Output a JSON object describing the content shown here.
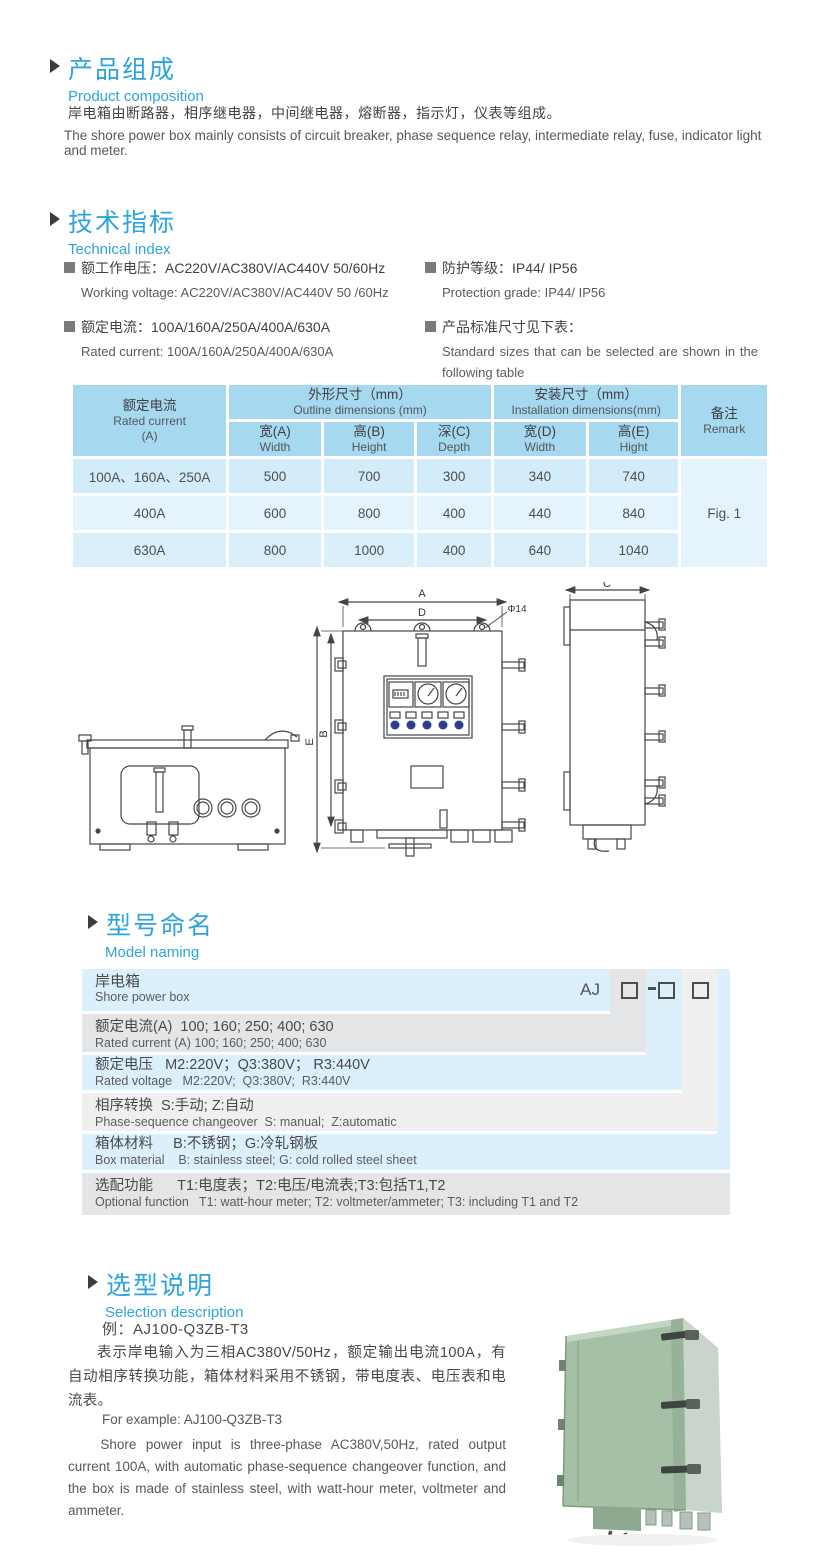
{
  "sections": {
    "composition": {
      "title_cn": "产品组成",
      "title_en": "Product  composition",
      "body_cn": "岸电箱由断路器，相序继电器，中间继电器，熔断器，指示灯，仪表等组成。",
      "body_en": "The shore power box mainly consists of circuit breaker, phase sequence relay, intermediate relay, fuse, indicator light and meter."
    },
    "technical": {
      "title_cn": "技术指标",
      "title_en": "Technical index",
      "specs": [
        {
          "cn": "额工作电压：AC220V/AC380V/AC440V  50/60Hz",
          "en": "Working voltage: AC220V/AC380V/AC440V 50 /60Hz"
        },
        {
          "cn": "额定电流：100A/160A/250A/400A/630A",
          "en": "Rated current: 100A/160A/250A/400A/630A"
        },
        {
          "cn": "防护等级：IP44/ IP56",
          "en": "Protection grade: IP44/ IP56"
        },
        {
          "cn": "产品标准尺寸见下表：",
          "en": "Standard sizes that can be selected are shown in the following table"
        }
      ]
    },
    "model_naming": {
      "title_cn": "型号命名",
      "title_en": "Model naming",
      "code_prefix": "AJ",
      "rows": [
        {
          "cn": "岸电箱",
          "en": "Shore power box"
        },
        {
          "cn": "额定电流(A)  100; 160; 250; 400; 630",
          "en": "Rated current (A) 100; 160; 250; 400; 630"
        },
        {
          "cn": "额定电压   M2:220V；Q3:380V； R3:440V",
          "en": "Rated voltage   M2:220V;  Q3:380V;  R3:440V"
        },
        {
          "cn": "相序转换  S:手动; Z:自动",
          "en": "Phase-sequence changeover  S: manual;  Z:automatic"
        },
        {
          "cn": "箱体材料     B:不锈钢；G:冷轧钢板",
          "en": "Box material    B: stainless steel; G: cold rolled steel sheet"
        },
        {
          "cn": "选配功能      T1:电度表；T2:电压/电流表;T3:包括T1,T2",
          "en": "Optional function   T1: watt-hour meter; T2: voltmeter/ammeter; T3: including T1 and T2"
        }
      ]
    },
    "selection": {
      "title_cn": "选型说明",
      "title_en": "Selection description",
      "example_cn": "例：AJ100-Q3ZB-T3",
      "body_cn": "表示岸电输入为三相AC380V/50Hz，额定输出电流100A，有自动相序转换功能，箱体材料采用不锈钢，带电度表、电压表和电流表。",
      "example_en": "For example: AJ100-Q3ZB-T3",
      "body_en": "Shore power input is three-phase AC380V,50Hz, rated output current 100A, with automatic phase-sequence changeover function, and the box is made of stainless steel, with watt-hour meter, voltmeter and ammeter."
    }
  },
  "dims_table": {
    "header": {
      "current_cn": "额定电流",
      "current_en": "Rated current",
      "current_unit": "(A)",
      "outline_cn": "外形尺寸（mm）",
      "outline_en": "Outline dimensions (mm)",
      "install_cn": "安装尺寸（mm）",
      "install_en": "Installation dimensions(mm)",
      "remark_cn": "备注",
      "remark_en": "Remark",
      "wa_cn": "宽(A)",
      "wa_en": "Width",
      "hb_cn": "高(B)",
      "hb_en": "Height",
      "dc_cn": "深(C)",
      "dc_en": "Depth",
      "wd_cn": "宽(D)",
      "wd_en": "Width",
      "he_cn": "高(E)",
      "he_en": "Hight"
    },
    "rows": [
      {
        "current": "100A、160A、250A",
        "wa": "500",
        "hb": "700",
        "dc": "300",
        "wd": "340",
        "he": "740"
      },
      {
        "current": "400A",
        "wa": "600",
        "hb": "800",
        "dc": "400",
        "wd": "440",
        "he": "840"
      },
      {
        "current": "630A",
        "wa": "800",
        "hb": "1000",
        "dc": "400",
        "wd": "640",
        "he": "1040"
      }
    ],
    "remark_value": "Fig. 1"
  },
  "drawing": {
    "dim_a": "A",
    "dim_d": "D",
    "dim_phi": "Φ14",
    "dim_e": "E",
    "dim_b": "B",
    "dim_c": "C"
  },
  "colors": {
    "accent_blue": "#2da4db",
    "table_header_blue": "#a6d8f0",
    "model_row_blue": "#dcf0fb",
    "model_row_gray": "#e4e5e6",
    "indicator_blue": "#2b3e91",
    "photo_green": "#a5c0a6"
  }
}
